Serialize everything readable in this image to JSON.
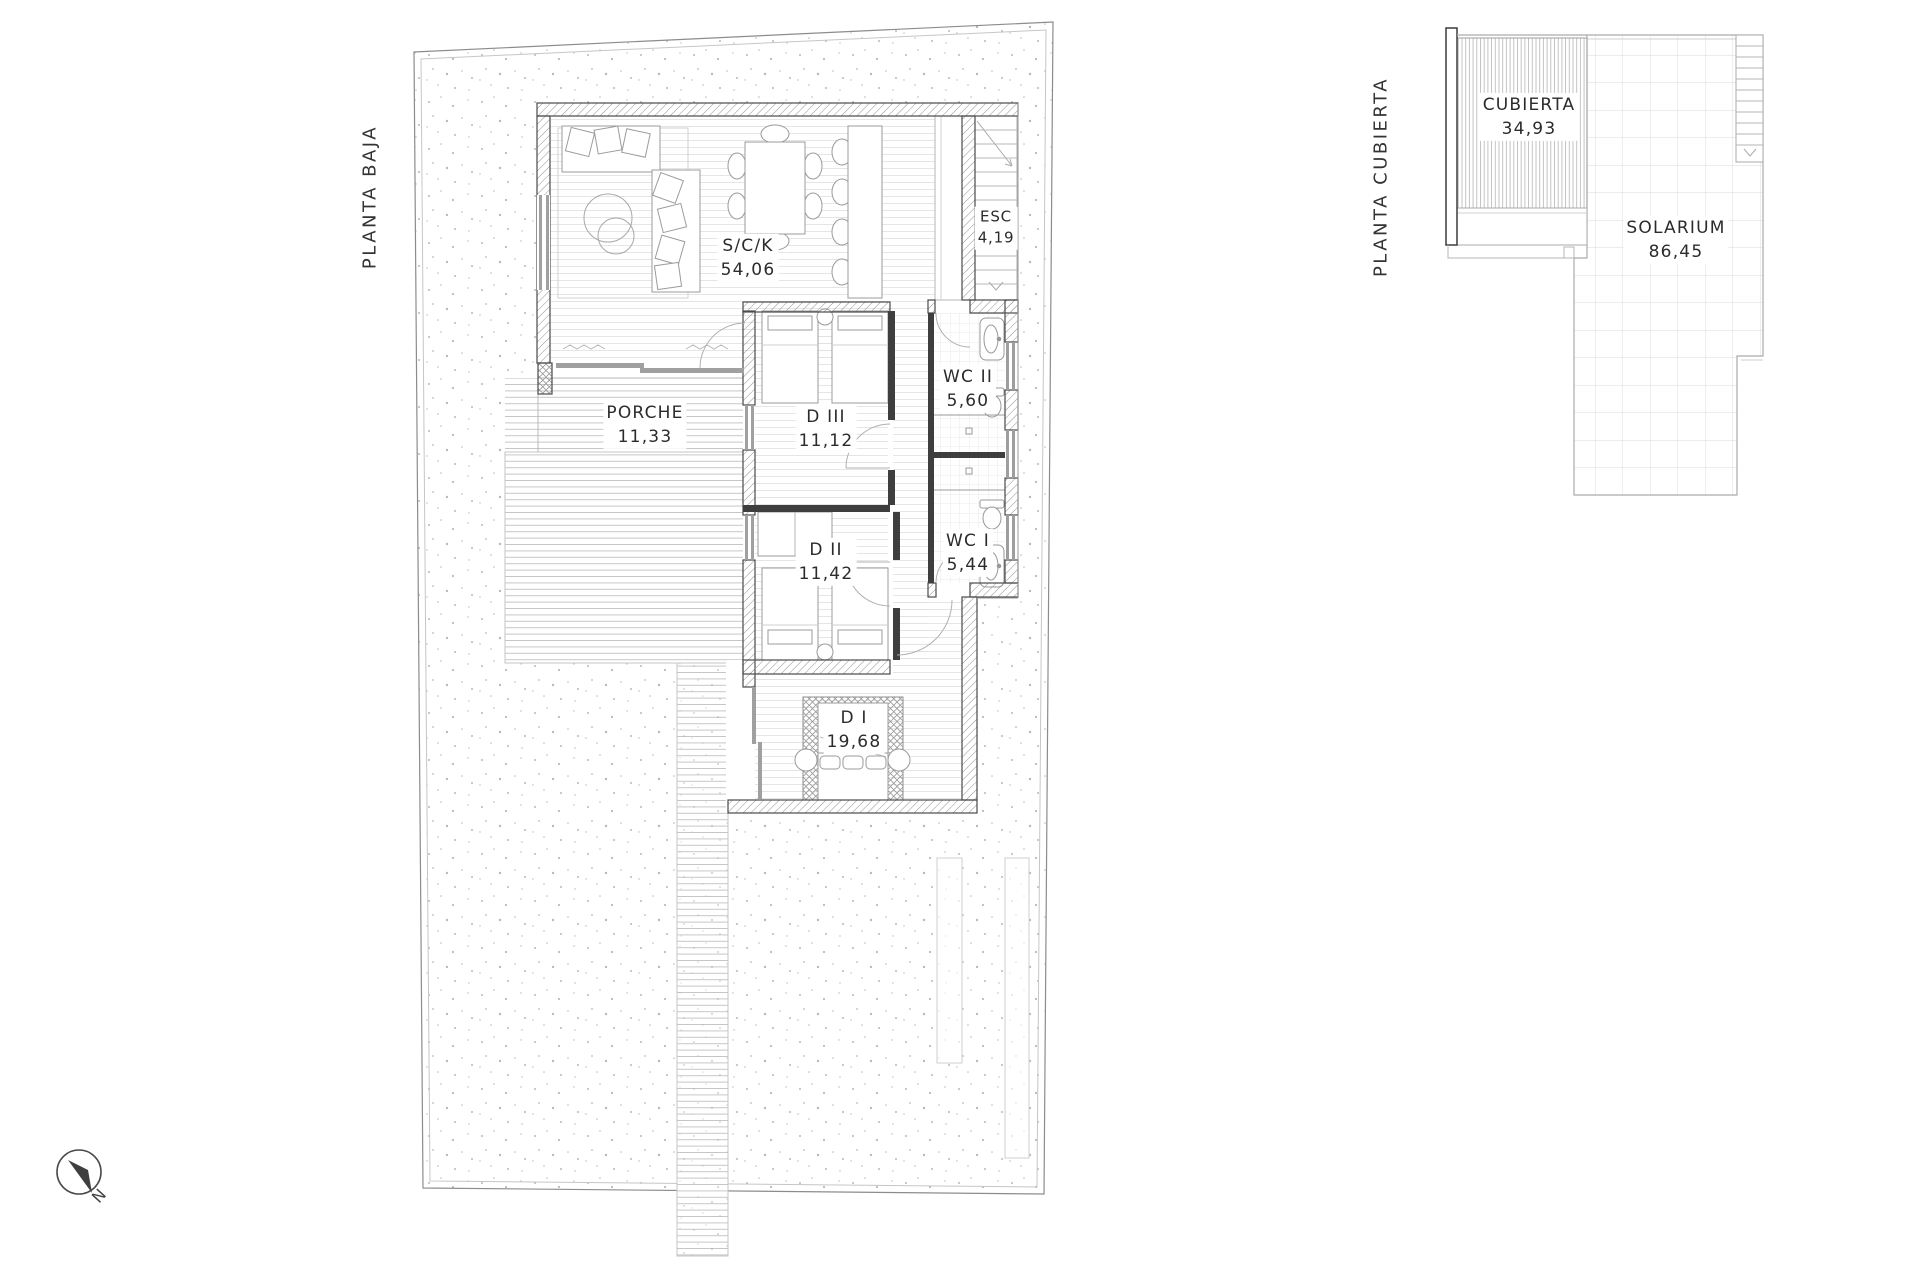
{
  "plans": [
    {
      "id": "planta-baja",
      "side_label": "PLANTA BAJA",
      "rooms": [
        {
          "name": "S/C/K",
          "area": "54,06"
        },
        {
          "name": "ESC",
          "area": "4,19"
        },
        {
          "name": "PORCHE",
          "area": "11,33"
        },
        {
          "name": "D III",
          "area": "11,12"
        },
        {
          "name": "WC II",
          "area": "5,60"
        },
        {
          "name": "D II",
          "area": "11,42"
        },
        {
          "name": "WC I",
          "area": "5,44"
        },
        {
          "name": "D I",
          "area": "19,68"
        }
      ]
    },
    {
      "id": "planta-cubierta",
      "side_label": "PLANTA CUBIERTA",
      "rooms": [
        {
          "name": "CUBIERTA",
          "area": "34,93"
        },
        {
          "name": "SOLARIUM",
          "area": "86,45"
        }
      ]
    }
  ],
  "compass": {
    "north_label": "N"
  },
  "colors": {
    "paper": "#ffffff",
    "wall_outline": "#4a4a4a",
    "wall_hatch": "#969696",
    "solid_wall": "#3e3e3e",
    "light_line": "#c9c9c9",
    "floor_line": "#e0e0e0",
    "text": "#2b2b2b"
  }
}
